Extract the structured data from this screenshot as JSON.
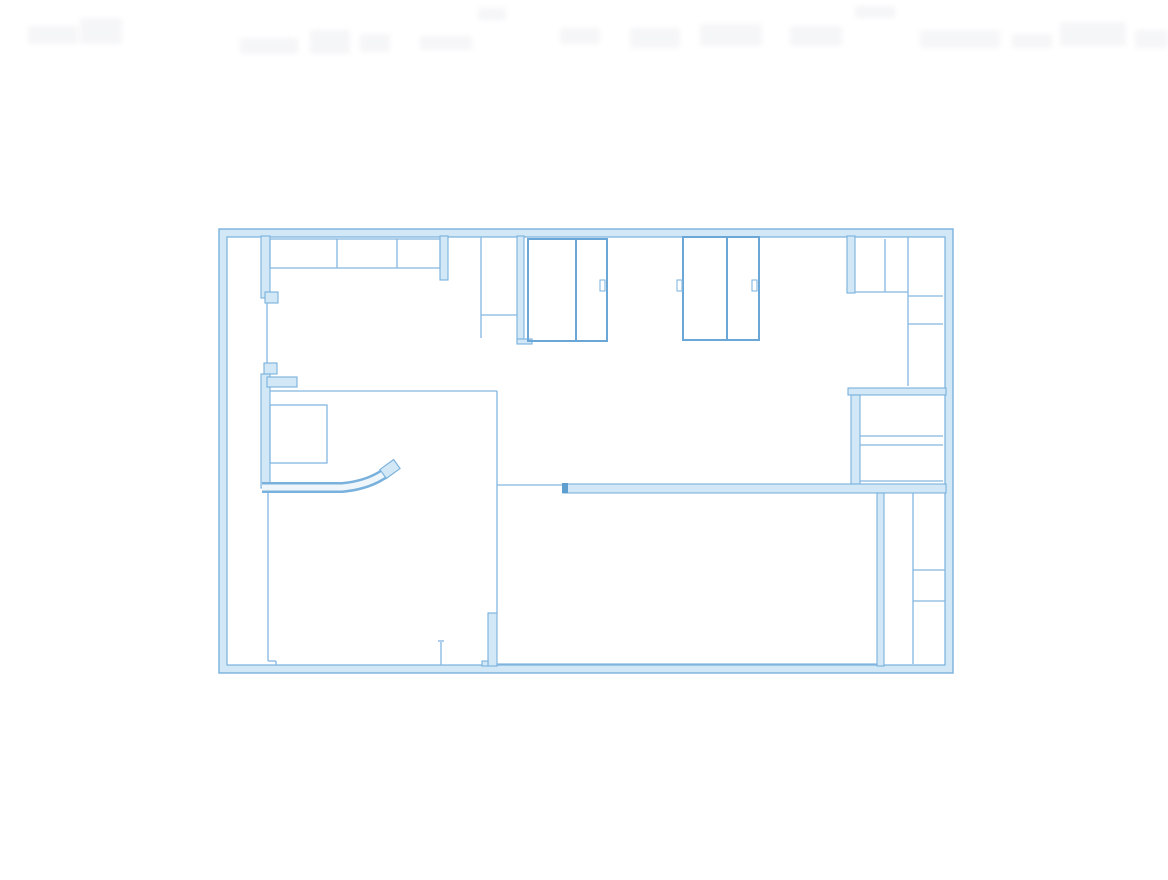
{
  "page": {
    "background": "#ffffff"
  },
  "drawing": {
    "name": "architectural-floor-plan-blueprint",
    "canvas": {
      "width": 1168,
      "height": 880
    },
    "palette": {
      "background": "#ffffff",
      "thin_line": "#84b7e1",
      "medium_line": "#6aa7d7",
      "wall_fill": "#d2e8f6",
      "wall_edge": "#79b1dc",
      "dark_cap": "#5f9fd0",
      "curve_core": "#eef6fc",
      "smudge": "#9aa3ab"
    },
    "outer_wall": {
      "outer_rect": [
        219,
        229,
        734,
        444
      ],
      "inner_rect": [
        227,
        237,
        718,
        428
      ]
    },
    "thick_walls": [
      {
        "name": "left-interior-wall-upper",
        "rect": [
          261,
          236,
          9,
          62
        ]
      },
      {
        "name": "left-wall-jamb-upper",
        "rect": [
          265,
          292,
          13,
          11
        ]
      },
      {
        "name": "left-wall-jamb-lower",
        "rect": [
          264,
          363,
          13,
          11
        ]
      },
      {
        "name": "left-interior-wall-lower",
        "rect": [
          261,
          374,
          9,
          114
        ]
      },
      {
        "name": "left-wall-stub",
        "rect": [
          267,
          377,
          30,
          10
        ]
      },
      {
        "name": "closet-row-end-cap",
        "rect": [
          440,
          236,
          8,
          44
        ]
      },
      {
        "name": "corridor-chase-wall",
        "rect": [
          517,
          236,
          7,
          106
        ]
      },
      {
        "name": "corridor-chase-wall-cap",
        "rect": [
          517,
          339,
          15,
          5
        ]
      },
      {
        "name": "right-upper-wall",
        "rect": [
          847,
          236,
          8,
          57
        ]
      },
      {
        "name": "storage-room-top-wall",
        "rect": [
          848,
          388,
          98,
          7
        ]
      },
      {
        "name": "storage-room-left-wall",
        "rect": [
          851,
          395,
          9,
          89
        ]
      },
      {
        "name": "long-dividing-wall",
        "rect": [
          563,
          484,
          383,
          9
        ]
      },
      {
        "name": "bottom-right-wall",
        "rect": [
          877,
          493,
          7,
          173
        ]
      },
      {
        "name": "lower-door-wall",
        "rect": [
          488,
          613,
          9,
          53
        ]
      },
      {
        "name": "lower-door-wall-foot",
        "rect": [
          482,
          661,
          6,
          5
        ]
      }
    ],
    "dark_caps": [
      {
        "name": "long-wall-end-cap",
        "rect": [
          562,
          483,
          6,
          10
        ]
      }
    ],
    "thin_lines": [
      [
        267,
        303,
        267,
        363
      ],
      [
        268,
        488,
        268,
        661
      ],
      [
        268,
        661,
        276,
        661
      ],
      [
        276,
        661,
        276,
        665
      ],
      [
        270,
        239,
        440,
        239
      ],
      [
        270,
        268,
        440,
        268
      ],
      [
        270,
        239,
        270,
        268
      ],
      [
        337,
        239,
        337,
        268
      ],
      [
        397,
        239,
        397,
        268
      ],
      [
        440,
        239,
        440,
        268
      ],
      [
        481,
        237,
        481,
        338
      ],
      [
        481,
        315,
        517,
        315
      ],
      [
        855,
        292,
        908,
        292
      ],
      [
        885,
        239,
        885,
        292
      ],
      [
        908,
        237,
        908,
        386
      ],
      [
        908,
        296,
        943,
        296
      ],
      [
        908,
        324,
        943,
        324
      ],
      [
        860,
        436,
        943,
        436
      ],
      [
        860,
        445,
        943,
        445
      ],
      [
        860,
        481,
        943,
        481
      ],
      [
        497,
        485,
        563,
        485
      ],
      [
        270,
        391,
        497,
        391
      ],
      [
        497,
        391,
        497,
        613
      ],
      [
        913,
        493,
        913,
        664
      ],
      [
        913,
        570,
        945,
        570
      ],
      [
        913,
        601,
        945,
        601
      ],
      [
        497,
        664,
        877,
        664
      ],
      [
        441,
        642,
        441,
        665
      ],
      [
        438,
        641,
        444,
        641
      ]
    ],
    "room_boxes": [
      {
        "name": "top-room-box-left",
        "rect": [
          528,
          239,
          79,
          102
        ],
        "divider_x": 576
      },
      {
        "name": "top-room-box-right",
        "rect": [
          683,
          237,
          76,
          103
        ],
        "divider_x": 727
      }
    ],
    "door_notches": [
      [
        600,
        280,
        5,
        11
      ],
      [
        677,
        280,
        5,
        11
      ],
      [
        752,
        280,
        5,
        11
      ]
    ],
    "fixtures": [
      {
        "name": "lower-left-fixture",
        "rect": [
          270,
          405,
          57,
          58
        ]
      }
    ],
    "curved_counter": {
      "path": "M 262 487.5 L 342 487.5 Q 370 485 388 471",
      "outer_width": 11,
      "inner_width": 6,
      "tip": {
        "cx": 390,
        "cy": 469,
        "w": 17,
        "h": 11,
        "angle": -36
      }
    },
    "header_smudges": [
      [
        28,
        26,
        50,
        18
      ],
      [
        80,
        18,
        42,
        26
      ],
      [
        240,
        38,
        58,
        16
      ],
      [
        310,
        30,
        40,
        24
      ],
      [
        360,
        34,
        30,
        18
      ],
      [
        420,
        36,
        52,
        14
      ],
      [
        478,
        8,
        28,
        12
      ],
      [
        560,
        28,
        40,
        16
      ],
      [
        630,
        28,
        50,
        20
      ],
      [
        700,
        24,
        62,
        22
      ],
      [
        790,
        26,
        52,
        20
      ],
      [
        855,
        6,
        40,
        12
      ],
      [
        920,
        30,
        80,
        18
      ],
      [
        1012,
        34,
        40,
        14
      ],
      [
        1060,
        22,
        66,
        24
      ],
      [
        1135,
        30,
        33,
        18
      ]
    ]
  }
}
